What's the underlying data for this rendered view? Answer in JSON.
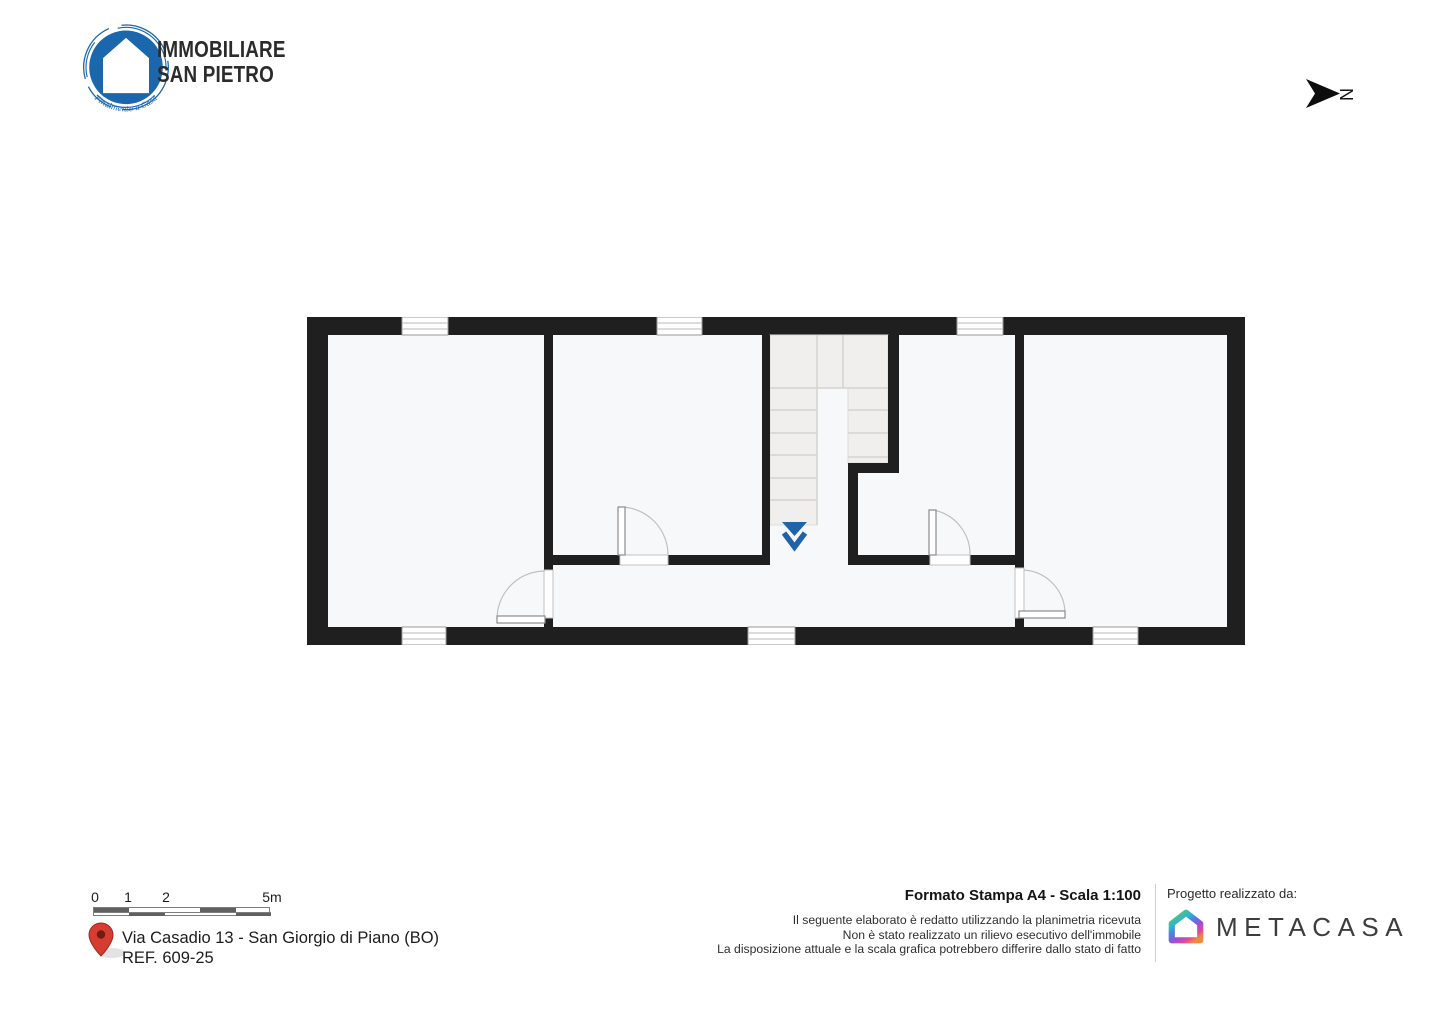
{
  "brand": {
    "line1": "IMMOBILIARE",
    "line2": "SAN PIETRO",
    "tagline": "Finalmente a Casa"
  },
  "compass": {
    "letter": "N"
  },
  "scalebar": {
    "labels": [
      "0",
      "1",
      "2",
      "5m"
    ]
  },
  "address": {
    "line1": "Via Casadio 13 - San Giorgio di Piano (BO)",
    "line2": "REF. 609-25"
  },
  "print_info": {
    "title": "Formato Stampa A4 - Scala 1:100",
    "disclaimer_lines": [
      "Il seguente elaborato è redatto utilizzando la planimetria ricevuta",
      "Non è stato realizzato un rilievo esecutivo dell'immobile",
      "La disposizione attuale e la scala grafica potrebbero differire dallo stato di fatto"
    ]
  },
  "credits": {
    "label": "Progetto realizzato da:",
    "brand": "METACASA"
  },
  "icons": {
    "north_arrow": "north-arrow-icon",
    "location_pin": "location-pin-icon",
    "brand_logo": "immobiliare-san-pietro-logo",
    "metacasa_logo": "metacasa-house-icon",
    "stair_direction": "stair-down-arrow-icon"
  },
  "colors": {
    "wall": "#1f1f1f",
    "floor": "#f7f8fa",
    "stair": "#f0efed",
    "arrow-blue": "#1f64a8",
    "brand-blue": "#1a67ad",
    "pin-red": "#d63c30",
    "meta-text": "#3d3d3f"
  }
}
